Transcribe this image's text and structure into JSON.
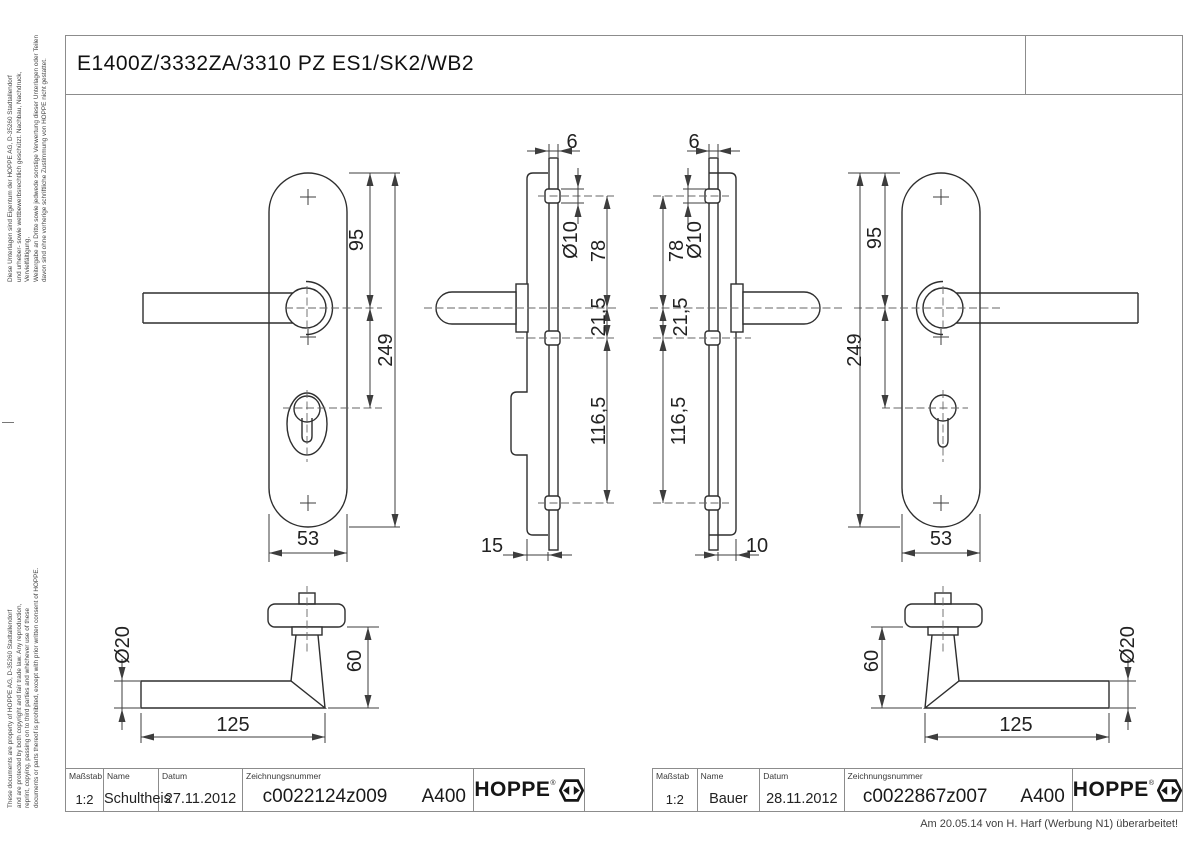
{
  "title": "E1400Z/3332ZA/3310 PZ ES1/SK2/WB2",
  "side_notes": {
    "german": "Diese Unterlagen sind Eigentum der  HOPPE AG, D-35260 Stadtallendorf\nund urheber- sowie wettbewerbsrechtlich geschützt. Nachbau, Nachdruck, Vervielfältigung,\nWeitergabe an Dritte sowie jedwede sonstige Verwertung dieser Unterlagen oder Teilen\ndavon sind ohne vorherige schriftliche Zustimmung von HOPPE nicht gestattet.",
    "english": "These documents are property of HOPPE AG, D-35260 Stadtallendorf\nand are protected by both copyright and fair trade law. Any reproduction,\nreprint, copying, passing on to third parties and whichever use of these\ndocuments or parts thereof is prohibited, except with prior written consent of HOPPE."
  },
  "footer_note": "Am 20.05.14 von H. Harf (Werbung N1) überarbeitet!",
  "title_blocks": [
    {
      "scale_label": "Maßstab",
      "scale": "1:2",
      "name_label": "Name",
      "name": "Schultheis",
      "date_label": "Datum",
      "date": "27.11.2012",
      "drawing_no_label": "Zeichnungsnummer",
      "drawing_no": "c0022124z009",
      "code": "A400",
      "brand": "HOPPE",
      "brand_reg": "®"
    },
    {
      "scale_label": "Maßstab",
      "scale": "1:2",
      "name_label": "Name",
      "name": "Bauer",
      "date_label": "Datum",
      "date": "28.11.2012",
      "drawing_no_label": "Zeichnungsnummer",
      "drawing_no": "c0022867z007",
      "code": "A400",
      "brand": "HOPPE",
      "brand_reg": "®"
    }
  ],
  "views": {
    "front_left": {
      "dims": {
        "to_handle": "95",
        "total": "249",
        "width": "53"
      }
    },
    "profile_left": {
      "dims": {
        "thickness": "6",
        "boss_dia": "Ø10",
        "top_to_handle": "78",
        "handle_to_mid": "21,5",
        "mid_to_bottom": "116,5",
        "depth": "15"
      }
    },
    "profile_right": {
      "dims": {
        "thickness": "6",
        "boss_dia": "Ø10",
        "top_to_handle": "78",
        "handle_to_mid": "21,5",
        "mid_to_bottom": "116,5",
        "depth": "10"
      }
    },
    "front_right": {
      "dims": {
        "to_handle": "95",
        "total": "249",
        "width": "53"
      }
    },
    "handle_left": {
      "dims": {
        "dia": "Ø20",
        "height": "60",
        "length": "125"
      }
    },
    "handle_right": {
      "dims": {
        "dia": "Ø20",
        "height": "60",
        "length": "125"
      }
    }
  }
}
